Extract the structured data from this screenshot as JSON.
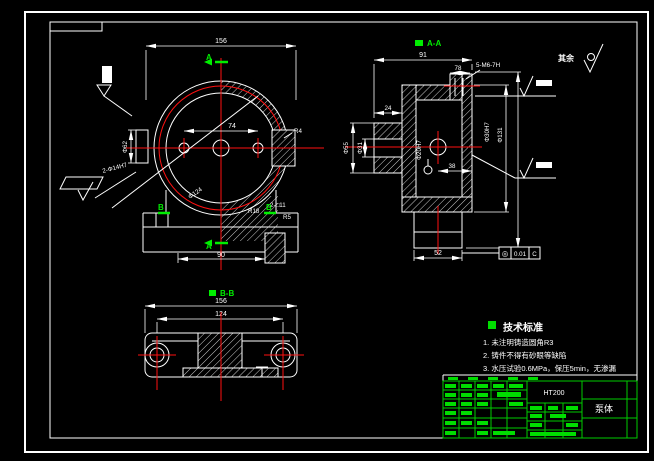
{
  "colors": {
    "background": "#000000",
    "line": "#ffffff",
    "centerline": "#ff1111",
    "accent_green": "#00dd00"
  },
  "sheet": {
    "surface_note": "其余"
  },
  "front_view": {
    "section_marker_a": "A",
    "section_marker_b": "B",
    "dim_width": "156",
    "dim_hole_spacing": "74",
    "dim_base": "90",
    "dim_boss": "Φ62",
    "label_holes": "2-Φ14H7",
    "label_circle": "Φ124",
    "label_r4": "R4",
    "label_r18": "R18",
    "label_slot": "2-□11",
    "label_r5": "R5"
  },
  "section_a": {
    "title": "A-A",
    "dim_depth": "91",
    "dim_step": "78",
    "label_tapped": "5-M6-7H",
    "dim_phi55": "Φ55",
    "dim_phi31": "Φ31",
    "dim_24": "24",
    "label_bore": "Φ20H7",
    "dim_38": "38",
    "dim_phi30h7": "Φ30H7",
    "dim_phi131": "Φ131",
    "dim_foot": "52",
    "tolerance_symbol": "◎",
    "tolerance_value": "0.01",
    "tolerance_datum": "C"
  },
  "section_b": {
    "title": "B-B",
    "dim_width": "156",
    "dim_spacing": "124"
  },
  "tech": {
    "title": "技术标准",
    "item1": "1. 未注明铸造圆角R3",
    "item2": "2. 铸件不得有砂眼等缺陷",
    "item3": "3. 水压试验0.6MPa，保压5min，无渗漏"
  },
  "title_block": {
    "material": "HT200",
    "part_name": "泵体"
  }
}
